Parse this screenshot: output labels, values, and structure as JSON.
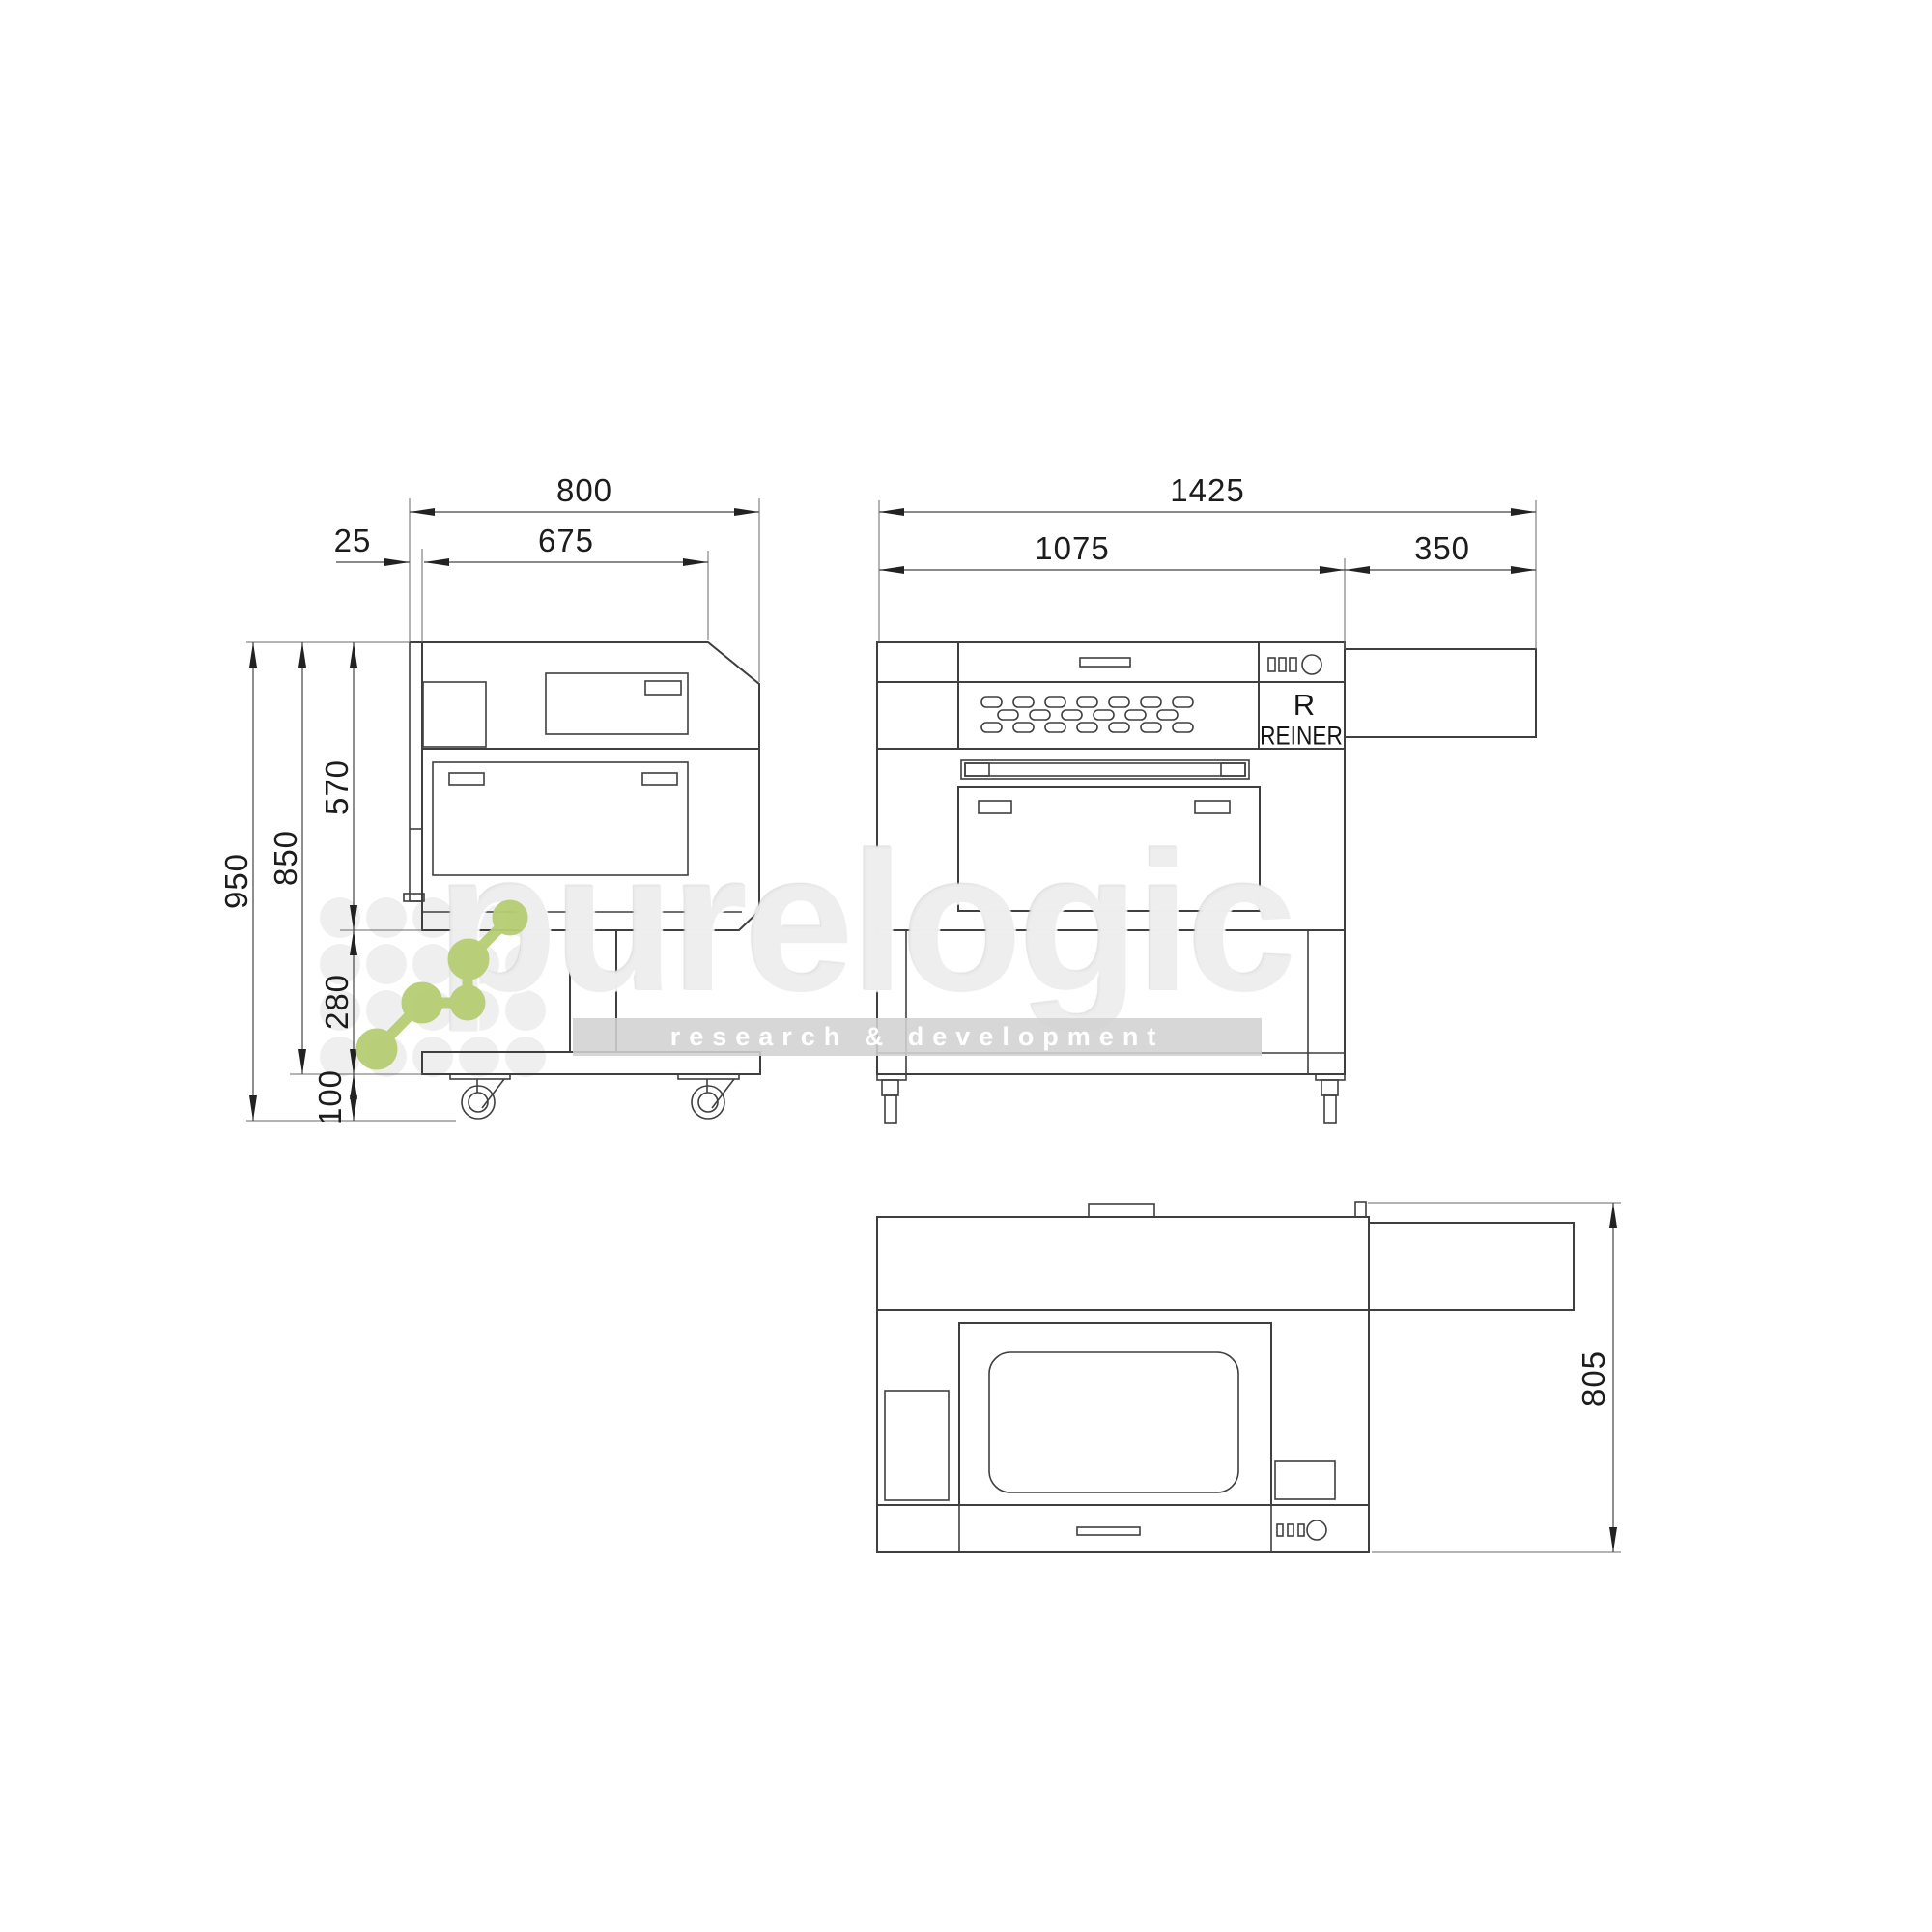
{
  "side": {
    "dims": {
      "overall_width": "800",
      "upper_width": "675",
      "back_offset": "25",
      "total_height": "950",
      "height_without_casters": "850",
      "body_height": "570",
      "stand_height": "280",
      "caster_height": "100"
    }
  },
  "front": {
    "dims": {
      "overall_width": "1425",
      "body_width": "1075",
      "exhaust_width": "350"
    },
    "logo_r": "R",
    "logo_name": "REINER"
  },
  "top": {
    "dims": {
      "depth": "805"
    }
  },
  "watermark": {
    "brand": "purelogic",
    "tagline": "research & development",
    "accent_color": "#b6cd72",
    "dot_color": "#efefef",
    "line_color": "#3f3f3f"
  }
}
